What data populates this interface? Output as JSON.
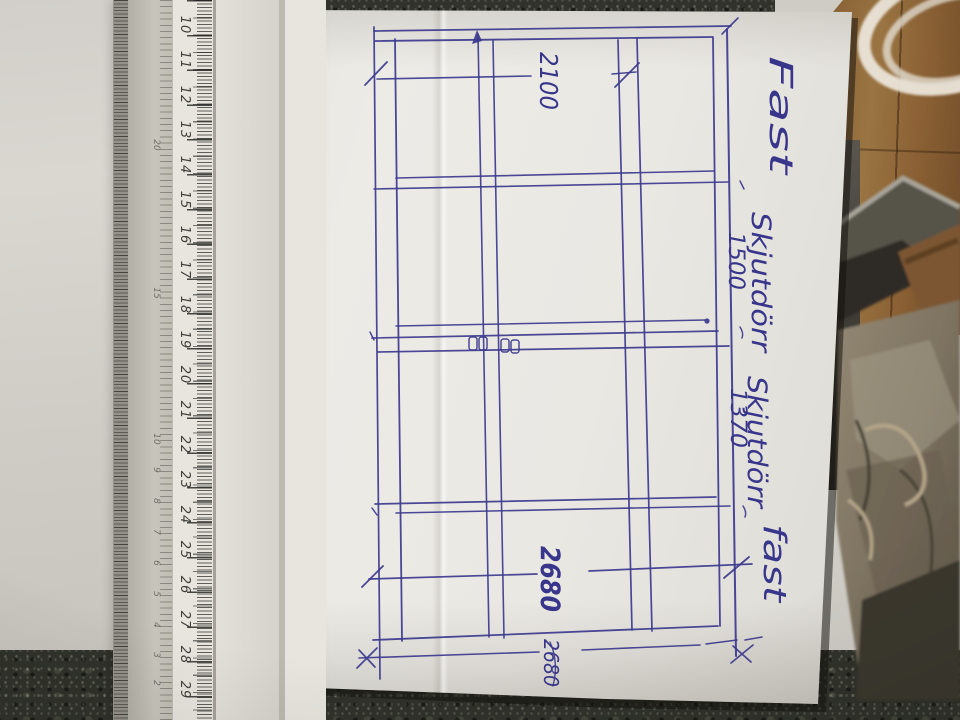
{
  "scene": {
    "description": "Photo of a hand-drawn sliding-door elevation sketch on white paper, lying on a dark granite countertop next to a triangular scale ruler, with wooden floor, a coiled white cable, stacked frames and a crumpled paper bag visible at the upper right."
  },
  "colors": {
    "ink": "#3c3a8e",
    "paper": "#e9e7e2",
    "granite": "#30322b",
    "wood": "#8a6437",
    "side_surface": "#cfccc6",
    "ruler_face": "#e7e5de"
  },
  "ruler": {
    "main_scale": [
      "10",
      "11",
      "12",
      "13",
      "14",
      "15",
      "16",
      "17",
      "18",
      "19",
      "20",
      "21",
      "22",
      "23",
      "24",
      "25",
      "26",
      "27",
      "28",
      "29"
    ],
    "bevel_scale": [
      "20",
      "15",
      "10",
      "9",
      "8",
      "7",
      "6",
      "5",
      "4",
      "3",
      "2"
    ]
  },
  "sketch": {
    "annotation": "Dörrar höjd 2100 totalBredd 4800 total höjd=2680",
    "section_labels": [
      "Fast",
      "Skjutdörr",
      "Skjutdörr",
      "fast"
    ],
    "dimensions": {
      "panel_width_1": "1500",
      "panel_width_2": "1370",
      "door_height": "2100",
      "total_height": "2680",
      "total_height_note": "2680"
    }
  }
}
